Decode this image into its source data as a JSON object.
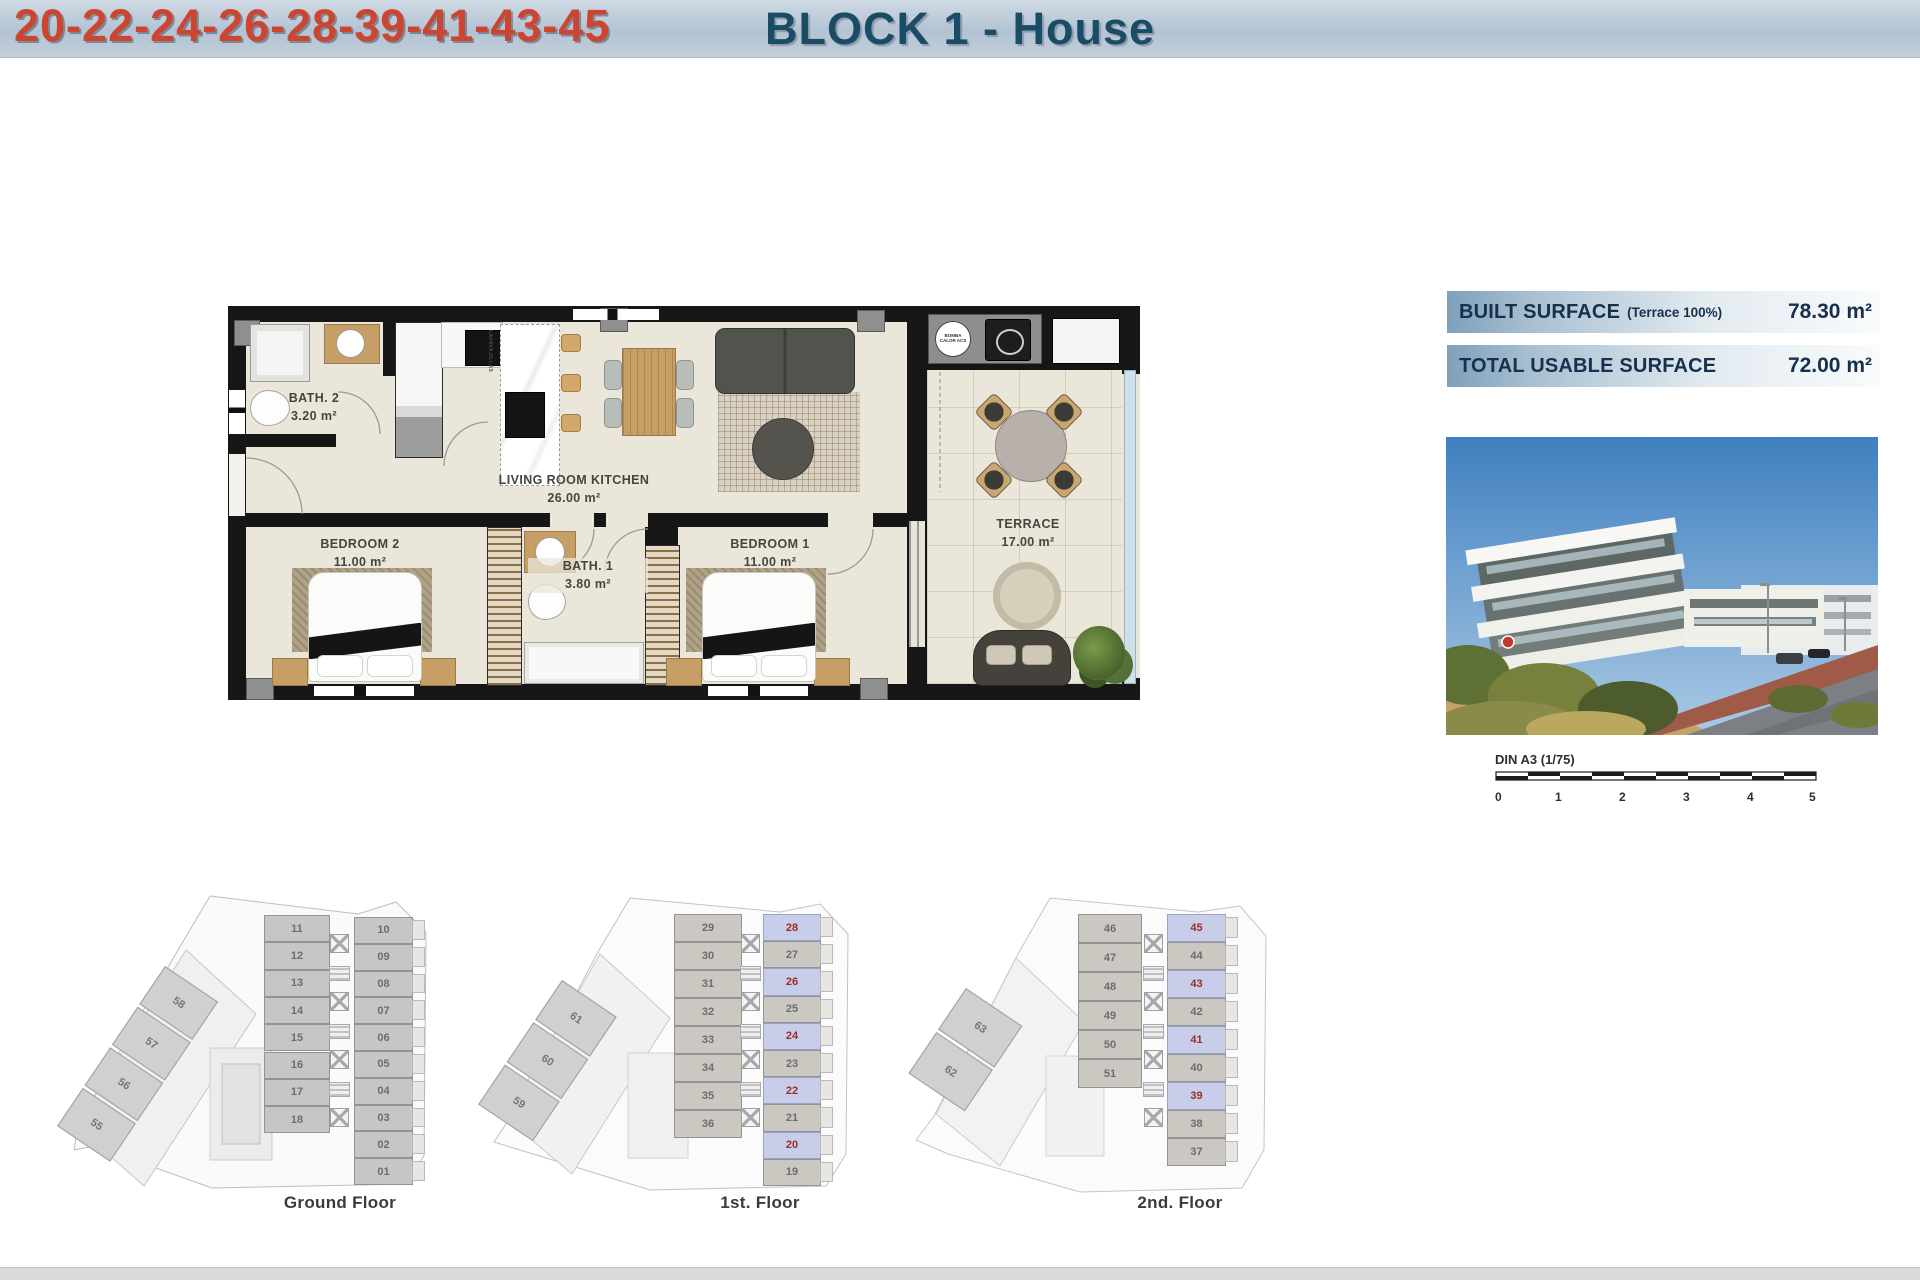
{
  "header": {
    "title_block": "BLOCK 1 - House",
    "title_units": "20-22-24-26-28-39-41-43-45"
  },
  "surface_table": {
    "rows": [
      {
        "label": "BUILT SURFACE",
        "note": "(Terrace 100%)",
        "value": "78.30 m²"
      },
      {
        "label": "TOTAL USABLE SURFACE",
        "note": "",
        "value": "72.00 m²"
      }
    ]
  },
  "floor_plan": {
    "rooms": [
      {
        "name": "BATH. 2",
        "area": "3.20 m²"
      },
      {
        "name": "BEDROOM 2",
        "area": "11.00 m²"
      },
      {
        "name": "BATH. 1",
        "area": "3.80 m²"
      },
      {
        "name": "BEDROOM 1",
        "area": "11.00 m²"
      },
      {
        "name": "LIVING ROOM KITCHEN",
        "area": "26.00 m²"
      },
      {
        "name": "TERRACE",
        "area": "17.00 m²"
      }
    ],
    "utility_labels": [
      "BOMBA CALOR ACS",
      "LAVAVAJILLAS"
    ]
  },
  "scale_bar": {
    "label": "DIN A3 (1/75)",
    "ticks": [
      "0",
      "1",
      "2",
      "3",
      "4",
      "5"
    ]
  },
  "mini_plans": [
    {
      "label": "Ground Floor",
      "left_units": [
        "11",
        "12",
        "13",
        "14",
        "15",
        "16",
        "17",
        "18"
      ],
      "right_units": [
        "10",
        "09",
        "08",
        "07",
        "06",
        "05",
        "04",
        "03",
        "02",
        "01"
      ],
      "diag_units": [
        "58",
        "57",
        "56",
        "55"
      ],
      "highlighted": []
    },
    {
      "label": "1st. Floor",
      "left_units": [
        "29",
        "30",
        "31",
        "32",
        "33",
        "34",
        "35",
        "36"
      ],
      "right_units": [
        "28",
        "27",
        "26",
        "25",
        "24",
        "23",
        "22",
        "21",
        "20",
        "19"
      ],
      "diag_units": [
        "61",
        "60",
        "59"
      ],
      "highlighted": [
        "28",
        "26",
        "24",
        "22",
        "20"
      ]
    },
    {
      "label": "2nd. Floor",
      "left_units": [
        "46",
        "47",
        "48",
        "49",
        "50",
        "51"
      ],
      "right_units": [
        "45",
        "44",
        "43",
        "42",
        "41",
        "40",
        "39",
        "38",
        "37"
      ],
      "diag_units": [
        "63",
        "62"
      ],
      "highlighted": [
        "45",
        "43",
        "41",
        "39"
      ]
    }
  ],
  "colors": {
    "title_blue": "#1b4c66",
    "title_red": "#cc4531",
    "table_text": "#16304e",
    "highlight_fill": "#c8cee9",
    "highlight_number": "#9c2c26"
  }
}
